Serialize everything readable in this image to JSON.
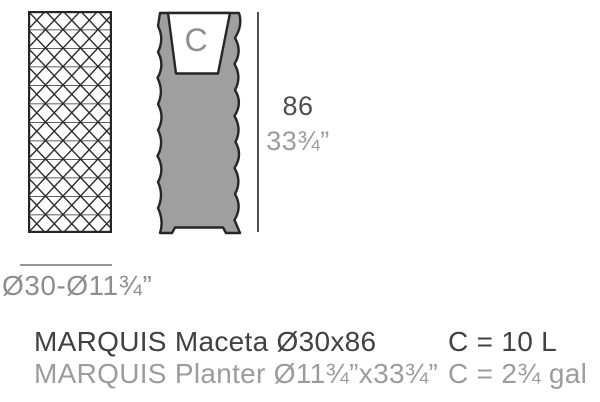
{
  "figure": {
    "section_label": "C"
  },
  "dimensions": {
    "height_cm": "86",
    "height_in": "33¾”",
    "diameter": "Ø30-Ø11¾”"
  },
  "specs": {
    "rows": [
      {
        "name": "MARQUIS Maceta Ø30x86",
        "capacity": "C = 10 L"
      },
      {
        "name": "MARQUIS Planter Ø11¾”x33¾”",
        "capacity": "C = 2¾ gal"
      }
    ]
  },
  "colors": {
    "outline": "#262626",
    "body_gray": "#9f9f9f",
    "text_dark": "#414141",
    "text_light": "#9c9c9c",
    "text_mid": "#8e8e8e",
    "dim_line": "#4f4f4f"
  }
}
